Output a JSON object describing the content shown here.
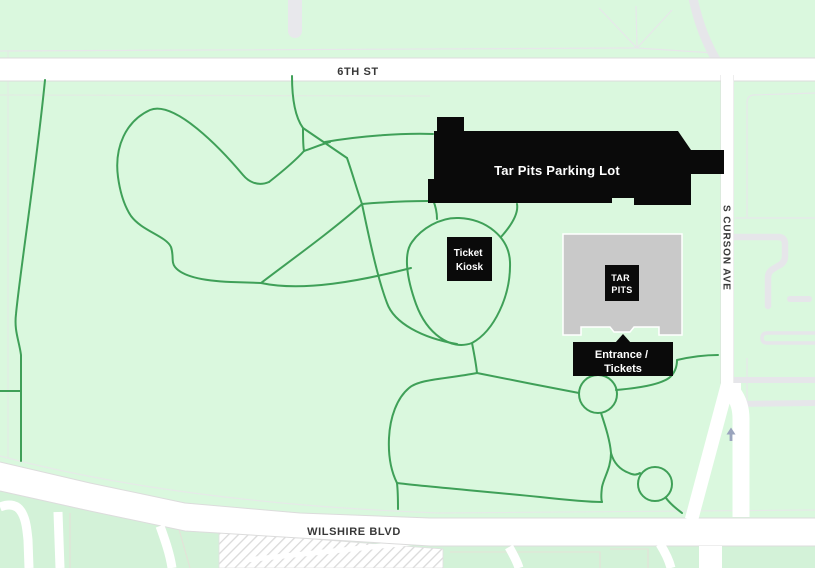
{
  "map": {
    "roads": {
      "sixth_st": "6TH ST",
      "wilshire": "WILSHIRE BLVD",
      "curson": "S CURSON AVE"
    },
    "labels": {
      "parking_lot": "Tar Pits Parking Lot",
      "ticket_kiosk_line1": "Ticket",
      "ticket_kiosk_line2": "Kiosk",
      "tar_pits_line1": "TAR",
      "tar_pits_line2": "PITS",
      "entrance_line1": "Entrance /",
      "entrance_line2": "Tickets"
    },
    "colors": {
      "park_green": "#daf8de",
      "south_green": "#d3f2d8",
      "path_green": "#3fa058",
      "road_white": "#ffffff",
      "road_casing": "#dcdcdc",
      "building_gray": "#c9c9c9",
      "label_black": "#0a0a0a",
      "label_text_white": "#ffffff",
      "road_text": "#383838",
      "gray_path": "#e6e6ea",
      "hatch_stripe": "#dadada",
      "arrow_blue": "#9aa4bd"
    }
  }
}
